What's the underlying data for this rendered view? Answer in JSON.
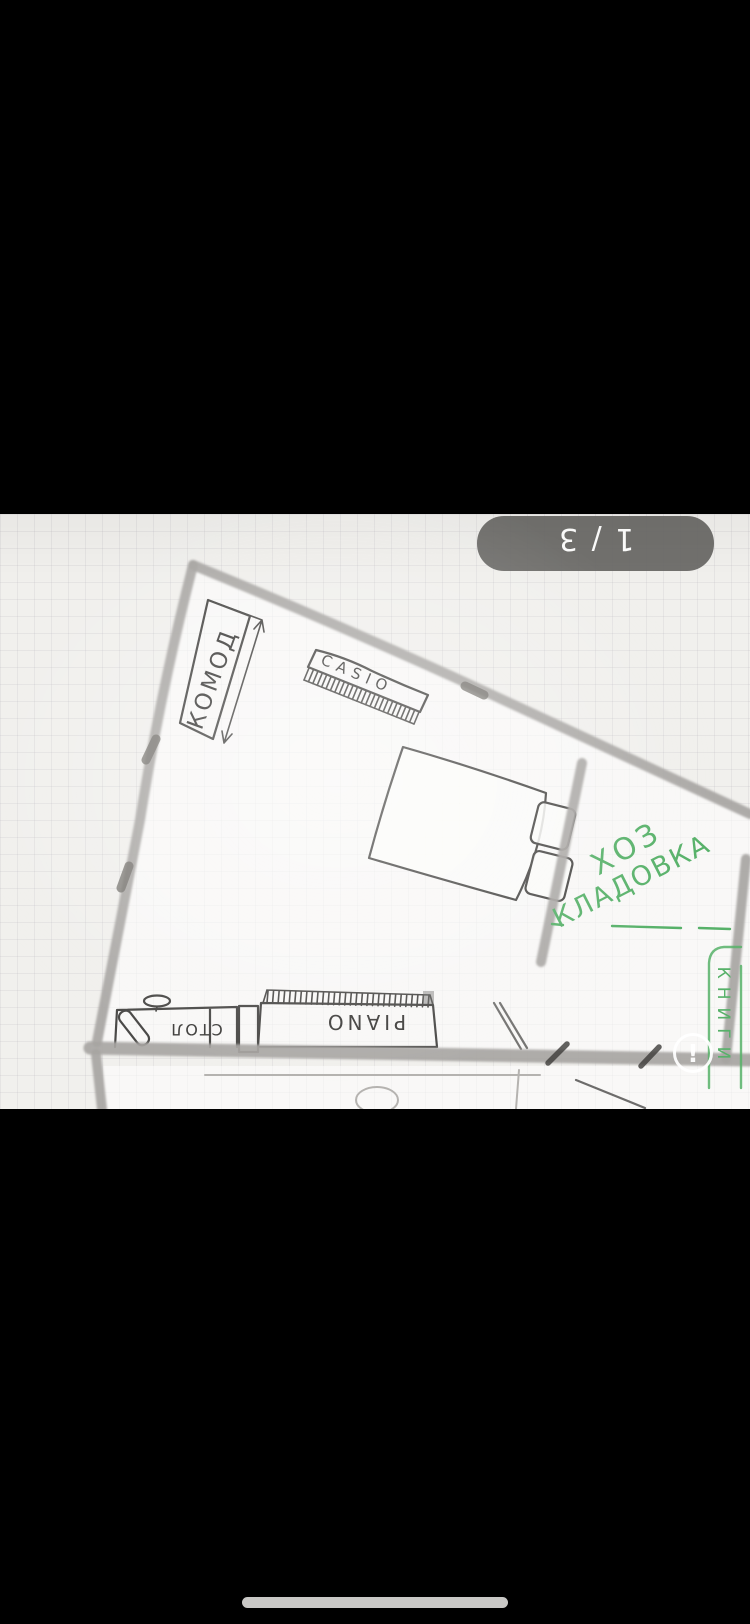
{
  "viewer": {
    "photo_counter": "1 / 3"
  },
  "floor_plan": {
    "labels": {
      "dresser": "КОМОД",
      "keyboard_brand": "CASIO",
      "piano": "PIANO",
      "desk": "СТОЛ",
      "storage_line1": "ХОЗ",
      "storage_line2": "КЛАДОВКА",
      "books": "КНИГИ"
    }
  },
  "icons": {
    "alert_glyph": "!"
  },
  "colors": {
    "pencil": "#4a4947",
    "wall": "#a7a5a2",
    "green": "#57b169",
    "pill": "#6b6a68",
    "paper": "#f1f0ed",
    "white": "#ffffff",
    "home_bar": "#c9c8c6",
    "ink": "#3f3e3c"
  }
}
